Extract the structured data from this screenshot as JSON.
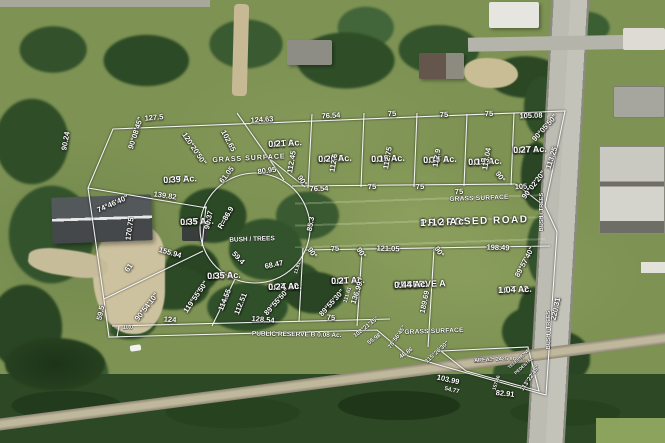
{
  "colors": {
    "overlay_line": "#ffffff",
    "label_text": "#ffffff"
  },
  "overlay": {
    "lots": [
      {
        "n": "lot-7-label",
        "lines": [
          "LOT 7",
          "0.39 Ac."
        ],
        "x": 163,
        "y": 176,
        "fs": 9,
        "r": -3
      },
      {
        "n": "lot-6-label",
        "lines": [
          "LOT 6",
          "0.21 Ac."
        ],
        "x": 268,
        "y": 140,
        "fs": 9,
        "r": -3
      },
      {
        "n": "lot-5-label",
        "lines": [
          "LOT 5",
          "0.20 Ac."
        ],
        "x": 318,
        "y": 155,
        "fs": 9,
        "r": -2
      },
      {
        "n": "lot-4-label",
        "lines": [
          "LOT 4",
          "0.19 Ac."
        ],
        "x": 371,
        "y": 155,
        "fs": 9,
        "r": -2
      },
      {
        "n": "lot-3-label",
        "lines": [
          "LOT 3",
          "0.19 Ac."
        ],
        "x": 423,
        "y": 156,
        "fs": 9,
        "r": -2
      },
      {
        "n": "lot-2-label",
        "lines": [
          "LOT 2",
          "0.19 Ac."
        ],
        "x": 468,
        "y": 158,
        "fs": 9,
        "r": -2
      },
      {
        "n": "lot-1-label",
        "lines": [
          "LOT 1",
          "0.27 Ac."
        ],
        "x": 513,
        "y": 146,
        "fs": 9,
        "r": -2
      },
      {
        "n": "lot-8-label",
        "lines": [
          "LOT 8",
          "0.35 Ac."
        ],
        "x": 180,
        "y": 218,
        "fs": 9,
        "r": -2
      },
      {
        "n": "lot-9-label",
        "lines": [
          "LOT 9",
          "0.35 Ac."
        ],
        "x": 207,
        "y": 272,
        "fs": 9,
        "r": -2
      },
      {
        "n": "lot-10-label",
        "lines": [
          "LOT 10",
          "0.24 Ac."
        ],
        "x": 268,
        "y": 283,
        "fs": 9,
        "r": -2
      },
      {
        "n": "lot-11-label",
        "lines": [
          "LOT 11",
          "0.21 Ac."
        ],
        "x": 331,
        "y": 277,
        "fs": 9,
        "r": -2
      },
      {
        "n": "lot-12-label",
        "lines": [
          "LOT 12",
          "1.04 Ac."
        ],
        "x": 498,
        "y": 286,
        "fs": 9,
        "r": -2
      },
      {
        "n": "lot-13-label",
        "lines": [
          "LOT 13",
          "AREA = 2425 sq. Ft."
        ],
        "x": 474,
        "y": 358,
        "fs": 5.5,
        "r": -3
      },
      {
        "n": "public-reserve-a-label",
        "lines": [
          "PUBLIC",
          "RESERVE A",
          "0.44 Ac."
        ],
        "x": 394,
        "y": 281,
        "fs": 9,
        "r": -2
      },
      {
        "n": "public-reserve-b-label",
        "lines": [
          "PUBLIC RESERVE B    0.08 Ac."
        ],
        "x": 252,
        "y": 330,
        "fs": 6.5,
        "r": 1
      },
      {
        "n": "proposed-road-label",
        "lines": [
          "PROPOSED ROAD",
          "1.12 Ac."
        ],
        "x": 420,
        "y": 219,
        "fs": 10,
        "r": -2,
        "ls": 1.5
      }
    ],
    "surfaces": [
      {
        "n": "grass-surface-label-1",
        "t": "GRASS  SURFACE",
        "x": 249,
        "y": 159,
        "fs": 7,
        "r": -3,
        "ls": 1
      },
      {
        "n": "grass-surface-label-2",
        "t": "GRASS SURFACE",
        "x": 479,
        "y": 198,
        "fs": 6.5,
        "r": -2,
        "ls": 0.5
      },
      {
        "n": "grass-surface-label-3",
        "t": "GRASS  SURFACE",
        "x": 434,
        "y": 331,
        "fs": 6.5,
        "r": -2,
        "ls": 0.5
      },
      {
        "n": "bush-trees-label-center",
        "t": "BUSH / TREES",
        "x": 252,
        "y": 239,
        "fs": 6.5,
        "r": -2
      },
      {
        "n": "bush-trees-label-right-1",
        "t": "BUSH / TREES",
        "x": 542,
        "y": 212,
        "fs": 5.5,
        "r": -90
      },
      {
        "n": "bush-trees-label-right-2",
        "t": "BUSH / TREES",
        "x": 549,
        "y": 330,
        "fs": 5.5,
        "r": -90
      },
      {
        "n": "telephone-pedestal-label-1",
        "t": "TELEPHONE",
        "x": 519,
        "y": 359,
        "fs": 4.5,
        "r": -42
      },
      {
        "n": "telephone-pedestal-label-2",
        "t": "PEDESTAL",
        "x": 524,
        "y": 366,
        "fs": 4.5,
        "r": -42
      }
    ],
    "dimensions": [
      [
        "127.5",
        154,
        118,
        -5
      ],
      [
        "124.63",
        262,
        120,
        -4
      ],
      [
        "76.54",
        331,
        116,
        -3
      ],
      [
        "75",
        392,
        114,
        -2
      ],
      [
        "75",
        444,
        115,
        -2
      ],
      [
        "75",
        489,
        114,
        -2
      ],
      [
        "105.08",
        531,
        116,
        -2
      ],
      [
        "90.24",
        66,
        141,
        -80
      ],
      [
        "90°08'45\"",
        136,
        133,
        -72
      ],
      [
        "120°20'50\"",
        194,
        149,
        56
      ],
      [
        "102.65",
        228,
        141,
        62
      ],
      [
        "112.45",
        292,
        162,
        -80
      ],
      [
        "112.6",
        334,
        163,
        -80
      ],
      [
        "112.75",
        388,
        158,
        -80
      ],
      [
        "112.9",
        437,
        158,
        -80
      ],
      [
        "113.04",
        487,
        159,
        -80
      ],
      [
        "113.25",
        552,
        158,
        -72
      ],
      [
        "90°05'50\"",
        545,
        128,
        -48
      ],
      [
        "61.05",
        227,
        175,
        -52
      ],
      [
        "80.95",
        267,
        171,
        -8
      ],
      [
        "90°",
        302,
        181,
        55
      ],
      [
        "76.54",
        319,
        189,
        -2
      ],
      [
        "75",
        372,
        187,
        -2
      ],
      [
        "75",
        420,
        187,
        -2
      ],
      [
        "75",
        459,
        192,
        -2
      ],
      [
        "90°",
        500,
        177,
        55
      ],
      [
        "105",
        521,
        187,
        -3
      ],
      [
        "90°02'20\"",
        534,
        185,
        -52
      ],
      [
        "139.82",
        165,
        196,
        8
      ],
      [
        "74°46'40\"",
        113,
        204,
        -24
      ],
      [
        "90.37",
        209,
        220,
        -78
      ],
      [
        "R=86.9",
        226,
        218,
        -60
      ],
      [
        "170.75",
        130,
        229,
        -82
      ],
      [
        "85.3",
        311,
        224,
        -80
      ],
      [
        "155.94",
        170,
        253,
        16
      ],
      [
        "59.4",
        238,
        258,
        46
      ],
      [
        "68.47",
        274,
        265,
        -12
      ],
      [
        "61",
        129,
        268,
        -55
      ],
      [
        "119°55'50\"",
        196,
        297,
        -55
      ],
      [
        "114.55",
        225,
        300,
        -68
      ],
      [
        "112.51",
        241,
        304,
        -68
      ],
      [
        "11.81",
        298,
        268,
        -72,
        5
      ],
      [
        "89°55'50\"",
        277,
        302,
        -48
      ],
      [
        "89°55'30\"",
        332,
        303,
        -48
      ],
      [
        "59.5",
        101,
        313,
        -78
      ],
      [
        "90°54'10\"",
        147,
        307,
        -52
      ],
      [
        "124",
        170,
        320,
        4
      ],
      [
        "10.0",
        128,
        328,
        0,
        5
      ],
      [
        "128.54",
        263,
        320,
        5
      ],
      [
        "75",
        331,
        318,
        2
      ],
      [
        "90°",
        312,
        253,
        55
      ],
      [
        "75",
        335,
        249,
        -4
      ],
      [
        "90°",
        361,
        253,
        55
      ],
      [
        "121.05",
        388,
        249,
        2
      ],
      [
        "90°",
        439,
        252,
        55
      ],
      [
        "198.49",
        498,
        248,
        2
      ],
      [
        "89°57'40\"",
        525,
        262,
        -62
      ],
      [
        "136.99",
        357,
        293,
        -72
      ],
      [
        "111.61",
        348,
        295,
        -72,
        5.5
      ],
      [
        "189.69",
        425,
        302,
        -78
      ],
      [
        "108°21'35\"",
        366,
        327,
        -38,
        6
      ],
      [
        "55.98",
        374,
        339,
        -35,
        6
      ],
      [
        "78°56'45\"",
        397,
        337,
        -55,
        6
      ],
      [
        "48.86",
        406,
        353,
        -35,
        6
      ],
      [
        "115°26'30\"",
        437,
        352,
        -42,
        6
      ],
      [
        "103.99",
        448,
        380,
        13
      ],
      [
        "54.77",
        452,
        390,
        13,
        6
      ],
      [
        "82.91",
        505,
        394,
        6
      ],
      [
        "113°22'45\"",
        530,
        378,
        -55,
        6
      ],
      [
        "157.46",
        497,
        383,
        -72,
        5
      ],
      [
        "220.31",
        556,
        309,
        -78
      ]
    ]
  }
}
